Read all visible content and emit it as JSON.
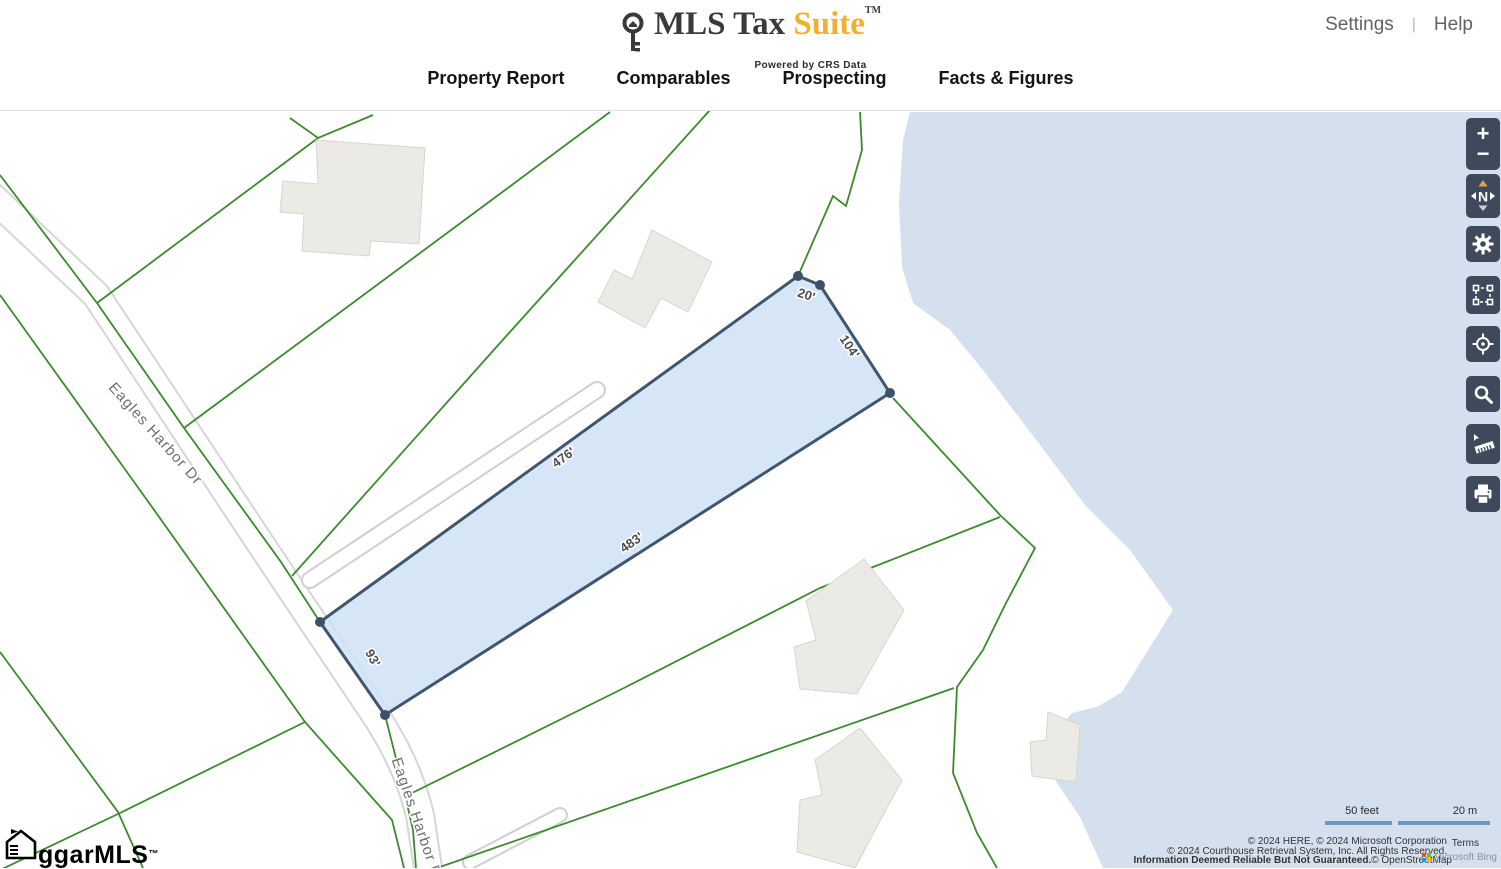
{
  "header": {
    "logo": {
      "title_dark": "MLS Tax",
      "title_accent": "Suite",
      "tm": "TM",
      "tagline": "Powered by CRS Data",
      "accent_color": "#f2b02c"
    },
    "links": {
      "settings": "Settings",
      "divider": "|",
      "help": "Help"
    },
    "nav": [
      {
        "label": "Property Report"
      },
      {
        "label": "Comparables"
      },
      {
        "label": "Prospecting"
      },
      {
        "label": "Facts & Figures"
      }
    ]
  },
  "map": {
    "road_labels": [
      "Eagles Harbor Dr",
      "Eagles Harbor Dr"
    ],
    "parcel": {
      "dimensions": [
        {
          "label": "20'"
        },
        {
          "label": "104'"
        },
        {
          "label": "476'"
        },
        {
          "label": "483'"
        },
        {
          "label": "93'"
        }
      ],
      "fill": "#cfe2f6",
      "stroke": "#41566e"
    },
    "colors": {
      "water": "#d4e0ed",
      "parcel_line_green": "#3c8a2e",
      "building": "#eceae4",
      "road_edge": "#d6d6d6",
      "control_bg": "#3e4a5b",
      "compass_arrow": "#e0a23e",
      "scale_bar": "#6d98c1"
    },
    "controls": {
      "zoom_in": "+",
      "zoom_out": "−",
      "compass_n": "N",
      "names": [
        "zoom-in",
        "zoom-out",
        "compass",
        "settings",
        "area-select",
        "locate",
        "search",
        "measure",
        "print"
      ]
    },
    "scale": {
      "feet_label": "50 feet",
      "meters_label": "20 m"
    },
    "attribution": {
      "line1": "© 2024 HERE, © 2024 Microsoft Corporation",
      "terms": "Terms",
      "line2": "© 2024 Courthouse Retrieval System, Inc. All Rights Reserved.",
      "line3_bold": "Information Deemed Reliable But Not Guaranteed.",
      "line3_osm": "© OpenStreetMap",
      "watermark": "Microsoft Bing"
    },
    "footer_logo": {
      "text": "ggarMLS",
      "tm": "™"
    }
  }
}
